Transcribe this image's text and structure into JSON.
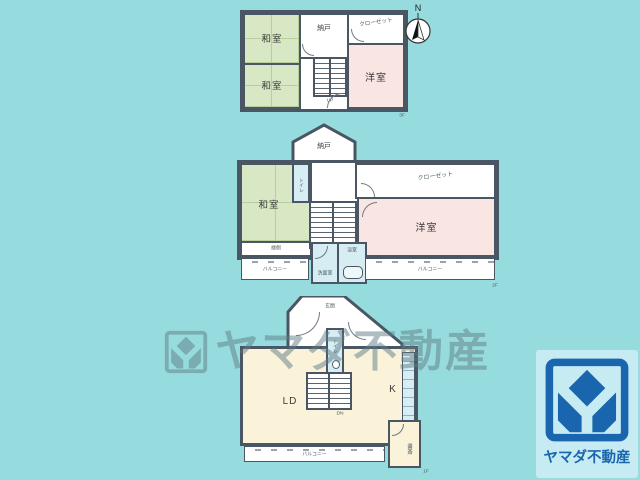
{
  "colors": {
    "background": "#96dcde",
    "wall": "#4a5663",
    "tatami_green": "#d9e8c4",
    "western_pink": "#f9e6e2",
    "living_cream": "#faf3da",
    "wet_blue": "#d5edf3",
    "brand_blue": "#1966ae",
    "logo_panel_blue": "#c6ebf2"
  },
  "compass": {
    "north_label": "N"
  },
  "floor3": {
    "tag": "3F",
    "washitsu_upper": "和室",
    "washitsu_lower": "和室",
    "nando": "納戸",
    "closet": "クローゼット",
    "yoshitsu": "洋室",
    "stairs": "UP"
  },
  "floor2": {
    "tag": "2F",
    "nando": "納戸",
    "washitsu": "和室",
    "toilet": "トイレ",
    "closet": "クローゼット",
    "yoshitsu": "洋室",
    "engawa": "縁側",
    "senmenshitsu": "洗面室",
    "yokushitsu": "浴室",
    "balcony_left": "バルコニー",
    "balcony_right": "バルコニー",
    "stairs_up": "UP",
    "stairs_down": "DN"
  },
  "floor1": {
    "tag": "1F",
    "genkan": "玄関",
    "toilet": "トイレ",
    "living_dining": "LD",
    "kitchen": "K",
    "shosai": "書斎",
    "balcony": "バルコニー",
    "stairs": "DN"
  },
  "watermark": {
    "text": "ヤマダ不動産"
  },
  "logo": {
    "company": "ヤマダ不動産"
  }
}
